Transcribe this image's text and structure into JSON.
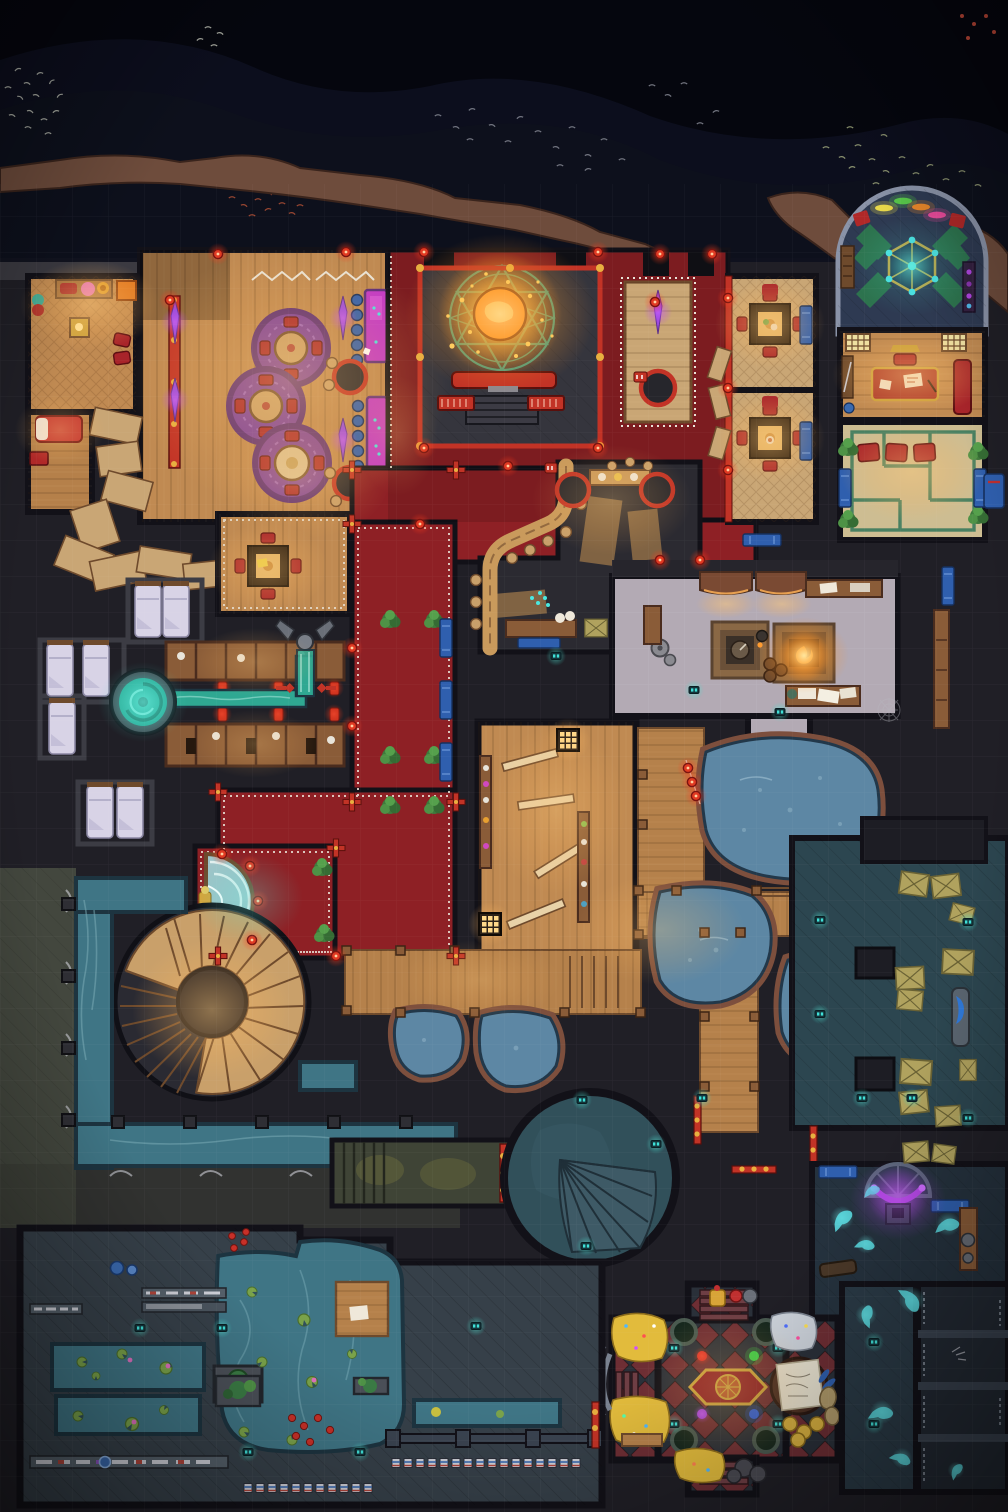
{
  "meta": {
    "kind": "top-down fantasy battle map",
    "theme": "night-time gambling den, bath house, hot-spring cave, sewers and treasure vault",
    "grid_square_px": 36,
    "width_px": 1008,
    "height_px": 1512,
    "visible_text": "none - the image contains no rendered text"
  },
  "palette": {
    "sky": "#05060e",
    "mountain": "#0e101c",
    "mountain_far": "#13152a",
    "cliff": "#6e4c3c",
    "cliff_shadow": "#452f26",
    "terrace": "#3b3a41",
    "base": "#201f26",
    "wall": "#121118",
    "wood_warm": "#c08a52",
    "wood_mid": "#a5723f",
    "wood_dark": "#6e4a2c",
    "wood_pale": "#c9a675",
    "carpet_red": "#8e2025",
    "rail_red": "#c23326",
    "trim_white": "#e9e4d8",
    "stage": "#35353d",
    "circle_teal": "#2fa08e",
    "orb_orange": "#ff9226",
    "table_magenta": "#c238c8",
    "banner_purple": "#9a4ae0",
    "rug_purple": "#7a3f9f",
    "rug_purple_dark": "#592c78",
    "chair_blue": "#2f5fae",
    "bed_white": "#d8d3e6",
    "spring_teal": "#2fa892",
    "pool_blue": "#5d87a4",
    "cave_rock": "#7d4f3d",
    "pale_floor": "#b3aab4",
    "storage_teal": "#2c4650",
    "crate_tan": "#b0a25e",
    "canal_teal": "#3f7585",
    "walk_olive": "#43473e",
    "sewer_floor": "#364049",
    "rotunda_teal": "#31505a",
    "check_red": "#6e2e34",
    "check_dark": "#2a3039",
    "gold": "#e2bb3c",
    "silver": "#ccd2da",
    "ghost_cyan": "#5ce0e6",
    "crystal_purple": "#b044e0",
    "lamp_teal": "#3fe0d8",
    "lantern_red": "#e23a22",
    "fire_orange": "#ff8c2a",
    "green_trim": "#3a7a5c",
    "tatami": "#cdbd92",
    "dome_floor": "#2e3a52",
    "dome_green": "#2d7a4e",
    "cushion_red": "#a8242a",
    "moss": "#6a6a3c"
  },
  "map_data": {
    "environment": [
      {
        "name": "night-sky",
        "kind": "exterior",
        "bounds_px": [
          0,
          0,
          1008,
          252
        ],
        "features": [
          "dark mountains silhouette",
          "five bird flocks (white, grey, red, olive)"
        ]
      },
      {
        "name": "cliff-edge",
        "kind": "terrain",
        "bounds_px": [
          0,
          150,
          1008,
          120
        ],
        "features": [
          "brown rocky rim along building top",
          "rock outcrops right of shrine dome"
        ]
      },
      {
        "name": "stone-terrace",
        "kind": "terrain",
        "bounds_px": [
          0,
          184,
          450,
          92
        ],
        "features": [
          "grey flagstones outside entrance"
        ]
      }
    ],
    "rooms": [
      {
        "name": "guest-suite",
        "bounds_px": [
          28,
          276,
          108,
          182
        ],
        "floor": "warm wood",
        "features": [
          "low table with red cushions",
          "pink pouf",
          "orange crate",
          "red bed with white pillow",
          "red bench"
        ]
      },
      {
        "name": "casino-hall",
        "bounds_px": [
          140,
          250,
          248,
          272
        ],
        "floor": "wood planks",
        "features": [
          "three purple round rugs with tables and red chairs",
          "two magenta gambling tables with cyan chips",
          "blue stools",
          "purple crystal banners",
          "three black round tables with red rims",
          "white garland on top wall"
        ]
      },
      {
        "name": "stage",
        "bounds_px": [
          420,
          268,
          180,
          178
        ],
        "floor": "dark planks",
        "features": [
          "teal summoning circle",
          "glowing orange orb with gold sparks",
          "red bench",
          "front steps",
          "red railing frame"
        ]
      },
      {
        "name": "red-carpet-hall",
        "bounds_px": [
          388,
          250,
          368,
          326
        ],
        "floor": "red carpet with white dotted trim",
        "features": [
          "wooden walkway island with round table and purple banner",
          "red paper lanterns"
        ]
      },
      {
        "name": "private-dining-rooms",
        "bounds_px": [
          728,
          276,
          88,
          246
        ],
        "floor": "woven mats",
        "features": [
          "two square tables with lit tops",
          "red cushions",
          "blue mats",
          "red railing with lanterns"
        ]
      },
      {
        "name": "shrine-dome",
        "bounds_px": [
          838,
          188,
          150,
          146
        ],
        "floor": "dark blue tiles",
        "features": [
          "arched wall",
          "green pinwheel inlay",
          "hexagonal gold-trimmed table with teal gems",
          "four coloured light bars",
          "red corner cushions",
          "bookshelf",
          "purple cabinet"
        ]
      },
      {
        "name": "office",
        "bounds_px": [
          840,
          330,
          145,
          90
        ],
        "floor": "wood",
        "features": [
          "red desk with gold trim and papers",
          "red sofa",
          "two wall lanterns",
          "weapon rack"
        ]
      },
      {
        "name": "tea-room",
        "bounds_px": [
          840,
          422,
          145,
          118
        ],
        "floor": "pale tatami with green maze trim",
        "features": [
          "three red cushions",
          "corner plants",
          "blue mats",
          "lantern posts"
        ]
      },
      {
        "name": "bar-kitchen",
        "bounds_px": [
          470,
          460,
          230,
          192
        ],
        "floor": "dark stone with tatami strips",
        "features": [
          "curved tan bar counter",
          "bar stools",
          "cyan chips",
          "two round tables with red rims",
          "food counter",
          "shelf with crates",
          "blue mat",
          "teal lamp"
        ]
      },
      {
        "name": "junction-parlor",
        "bounds_px": [
          218,
          514,
          132,
          100
        ],
        "floor": "wood with white trim",
        "features": [
          "square table with four red chairs"
        ]
      },
      {
        "name": "red-corridors",
        "bounds_px": [
          218,
          522,
          237,
          436
        ],
        "floor": "red carpet",
        "features": [
          "white dotted trim",
          "potted plants",
          "blue mats",
          "red cross lantern posts"
        ]
      },
      {
        "name": "fountain-alcove",
        "bounds_px": [
          195,
          846,
          140,
          112
        ],
        "floor": "red carpet",
        "features": [
          "semicircular white-water fountain",
          "gold statuette",
          "red lantern posts",
          "plants"
        ]
      },
      {
        "name": "dormitory",
        "bounds_px": [
          28,
          560,
          212,
          290
        ],
        "floor": "dark stone",
        "features": [
          "seven simple beds with lavender-white bedding in cells"
        ]
      },
      {
        "name": "bathing-stalls",
        "bounds_px": [
          166,
          642,
          178,
          122
        ],
        "floor": "dark stone",
        "features": [
          "two rows of wooden stalls",
          "small red wall lamps",
          "towels"
        ]
      },
      {
        "name": "whirlpool-spring",
        "bounds_px": [
          112,
          672,
          62,
          62
        ],
        "floor": "stone ring",
        "features": [
          "teal swirling spring",
          "water channel to dragon fountain"
        ]
      },
      {
        "name": "dragon-fountain",
        "bounds_px": [
          282,
          622,
          48,
          90
        ],
        "features": [
          "grey winged gargoyle",
          "teal water stream",
          "red rails with diamonds"
        ]
      },
      {
        "name": "changing-hall",
        "bounds_px": [
          478,
          722,
          158,
          234
        ],
        "floor": "wood planks",
        "features": [
          "four diagonal benches",
          "shelves with towels",
          "two glowing floor lanterns"
        ]
      },
      {
        "name": "workshop",
        "bounds_px": [
          612,
          560,
          286,
          156
        ],
        "floor": "pale mauve stone",
        "features": [
          "two awnings with warm light",
          "sunken compass hearth",
          "sunken fire hearth",
          "workbenches with scrolls",
          "barrels",
          "grindstones",
          "spider web"
        ]
      },
      {
        "name": "hot-spring-cave",
        "bounds_px": [
          345,
          720,
          560,
          415
        ],
        "features": [
          "five steaming blue pools with brown rock rims",
          "wooden boardwalks with posts",
          "steps into water",
          "two strings of red paper lanterns"
        ]
      },
      {
        "name": "storage-room",
        "bounds_px": [
          792,
          838,
          216,
          290
        ],
        "floor": "teal flagstones",
        "features": [
          "many wooden crates",
          "two square pillars",
          "blue mat",
          "teal lamps",
          "long shelf in corridor above"
        ]
      },
      {
        "name": "spiral-staircase",
        "bounds_px": [
          116,
          906,
          192,
          190
        ],
        "features": [
          "large curved tan stair sweeping almost a full turn"
        ]
      },
      {
        "name": "canal-walkway",
        "bounds_px": [
          0,
          868,
          460,
          404
        ],
        "features": [
          "teal canal along left wall and bottom",
          "olive stone walkway",
          "white pipe arches",
          "wall columns"
        ]
      },
      {
        "name": "mossy-corridor",
        "bounds_px": [
          332,
          1140,
          178,
          66
        ],
        "floor": "olive stone with moss",
        "features": [
          "staircase",
          "red and gold barred gate"
        ]
      },
      {
        "name": "fan-stair-rotunda",
        "bounds_px": [
          504,
          1092,
          172,
          172
        ],
        "floor": "mottled teal stone",
        "features": [
          "circular chamber",
          "fan shaped staircase",
          "teal lamps"
        ]
      },
      {
        "name": "gated-corridors",
        "bounds_px": [
          660,
          1092,
          348,
          170
        ],
        "features": [
          "red and gold barred gates",
          "teal lamps",
          "dark flagstones"
        ]
      },
      {
        "name": "seance-room",
        "bounds_px": [
          812,
          1164,
          196,
          158
        ],
        "floor": "dark teal tiles",
        "features": [
          "semicircular alcove with glowing purple crescent crystal",
          "altar",
          "cyan ghost wisps",
          "blue mats",
          "crates",
          "gear workbench",
          "wooden trough"
        ]
      },
      {
        "name": "treasure-vault",
        "bounds_px": [
          612,
          1284,
          226,
          210
        ],
        "floor": "red and black diamond checker",
        "features": [
          "gold coin piles with gem sparkles",
          "silver coin pile",
          "four dark round wells with teal lamps",
          "red rug with gold mandala",
          "four coloured orbs (red, green, purple, blue)",
          "round table with large map parchment",
          "gold plates",
          "sacks",
          "boulders",
          "statues",
          "stairs on four sides",
          "stone entry arch"
        ]
      },
      {
        "name": "ghost-corridor",
        "bounds_px": [
          842,
          1284,
          74,
          208
        ],
        "features": [
          "cyan ghost wisps",
          "teal lamps"
        ]
      },
      {
        "name": "prison-cells",
        "bounds_px": [
          918,
          1284,
          90,
          208
        ],
        "features": [
          "four dark cells",
          "hanging chains",
          "scratched bones"
        ]
      },
      {
        "name": "water-garden",
        "bounds_px": [
          20,
          1228,
          582,
          280
        ],
        "floor": "diagonal teal flagstones",
        "features": [
          "two lily-pad channels",
          "large pool with planters and streams",
          "dragon statue planter",
          "wooden dock with paper",
          "shelves of goods",
          "blue jars",
          "rows of striped market mats",
          "teal lamps",
          "red and gold gate"
        ]
      }
    ],
    "creatures_effects": [
      {
        "name": "bird-flocks",
        "count": 5
      },
      {
        "name": "ghost-wisps",
        "count": 9,
        "color": "#5ce0e6"
      },
      {
        "name": "summoning-orb",
        "color": "#ff9226"
      },
      {
        "name": "forge-fire",
        "color": "#ff8c2a"
      },
      {
        "name": "crystal-crescent",
        "color": "#b044e0"
      }
    ]
  }
}
